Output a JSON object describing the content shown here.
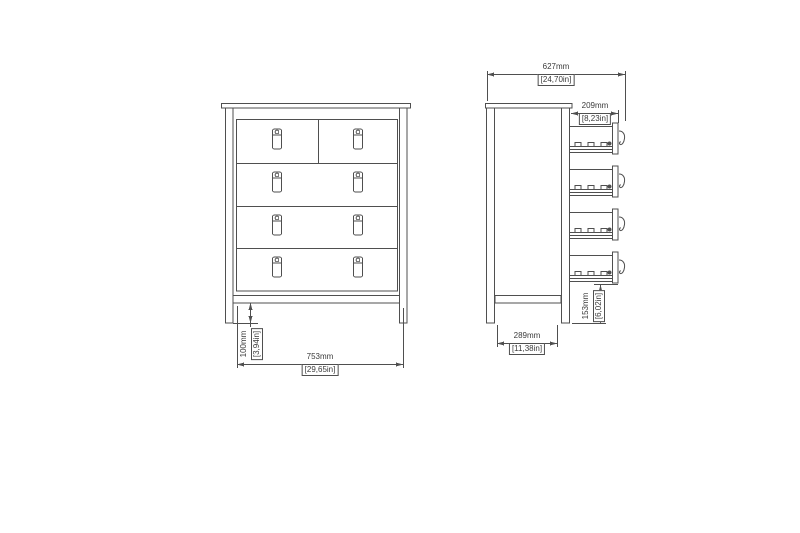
{
  "drawing": {
    "type": "furniture-dimension-diagram",
    "colors": {
      "line": "#4f4f4f",
      "text": "#3a3a3a",
      "background": "#ffffff"
    },
    "front_view": {
      "drawer_rows": 4,
      "top_row_drawers": 2,
      "handle_icon": "drop-pull-handle-icon",
      "dimensions": {
        "width": {
          "mm": "753mm",
          "inch": "[29,65in]"
        },
        "leg_height": {
          "mm": "100mm",
          "inch": "[3,94in]"
        }
      }
    },
    "side_view": {
      "open_drawers": 4,
      "handle_icon": "hook-handle-icon",
      "dimensions": {
        "overall_depth": {
          "mm": "627mm",
          "inch": "[24,70in]"
        },
        "drawer_extension": {
          "mm": "209mm",
          "inch": "[8,23in]"
        },
        "bottom_drawer_clearance": {
          "mm": "153mm",
          "inch": "[6,02in]"
        },
        "base_depth": {
          "mm": "289mm",
          "inch": "[11,38in]"
        }
      }
    }
  }
}
